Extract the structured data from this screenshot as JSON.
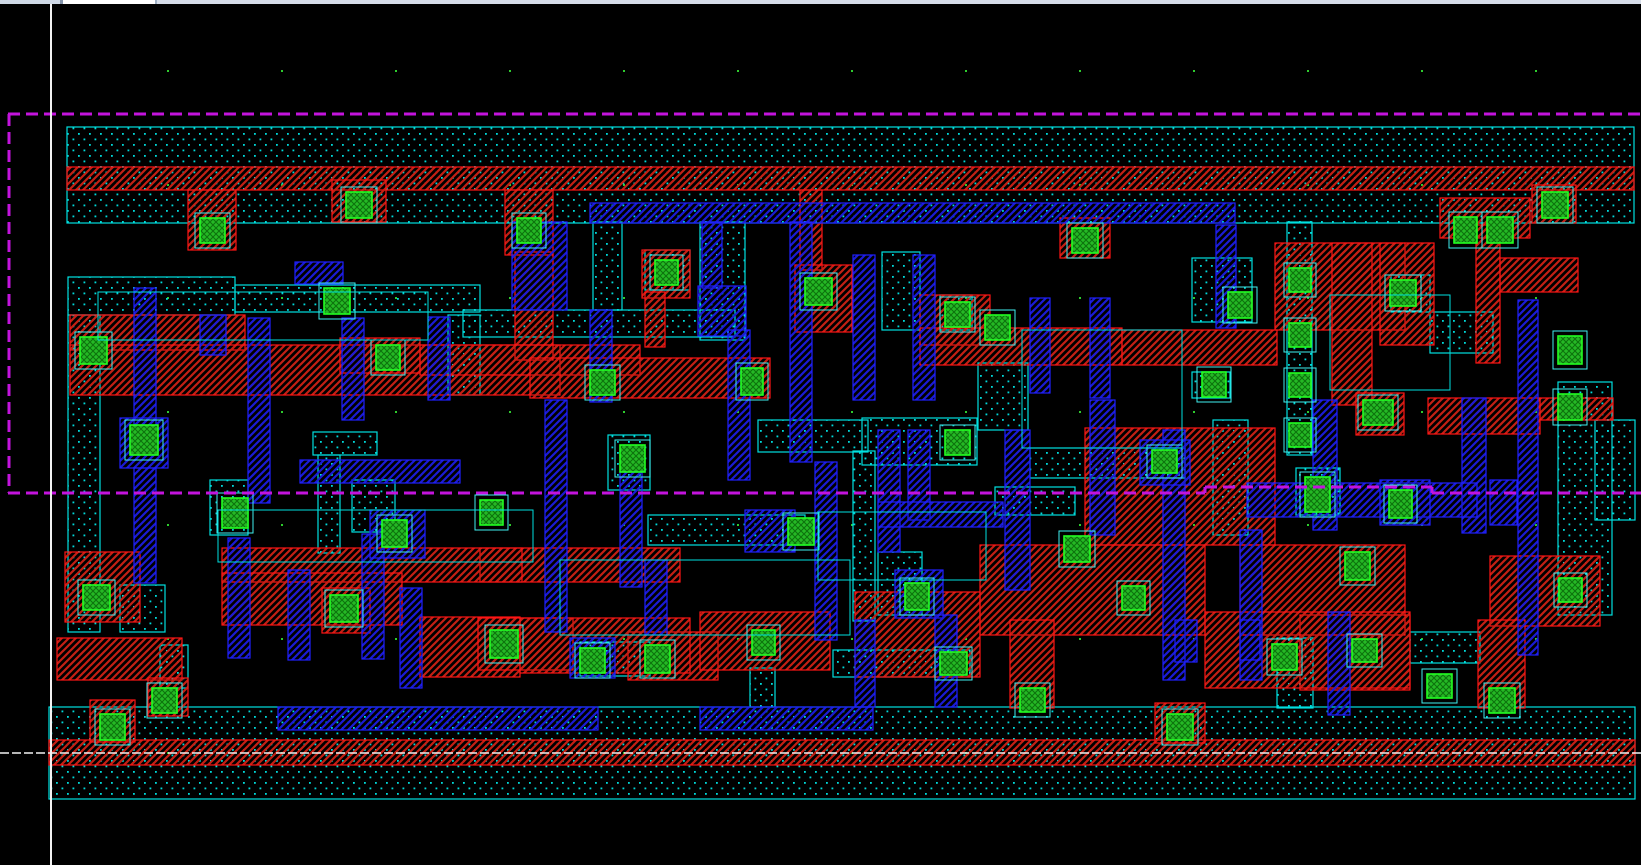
{
  "canvas": {
    "width": 1641,
    "height": 865,
    "background": "#000000"
  },
  "window": {
    "topbar": {
      "height": 4,
      "segments": [
        {
          "x": 0,
          "w": 60,
          "color": "#cfd9e6",
          "name": "topbar-left"
        },
        {
          "x": 60,
          "w": 3,
          "color": "#8494ab",
          "name": "topbar-divider-1"
        },
        {
          "x": 63,
          "w": 92,
          "color": "#ffffff",
          "name": "topbar-white-tab"
        },
        {
          "x": 155,
          "w": 2,
          "color": "#9fb0c4",
          "name": "topbar-divider-2"
        },
        {
          "x": 157,
          "w": 1484,
          "color": "#d6dde9",
          "name": "topbar-right"
        }
      ]
    }
  },
  "colors": {
    "background": "#000000",
    "diff_outline": "#00e0e0",
    "diff_dot": "#00d9d9",
    "red_line": "#c42014",
    "red_outline": "#ff1515",
    "blue_line": "#1b1bd6",
    "blue_outline": "#2020ff",
    "contact_fill": "#25b825",
    "contact_line": "#0d720d",
    "contact_outline": "#22ff22",
    "contact_halo": "#40f0f0",
    "boundary": "#c314dd",
    "axis": "#f2f2f2",
    "grid_dot": "#2ecc2e"
  },
  "grid": {
    "x_start": 167,
    "x_step": 114,
    "x_count": 13,
    "y_rows": [
      70,
      184,
      297,
      411,
      524,
      638,
      752
    ]
  },
  "axes": {
    "vertical_x": 51,
    "vertical_y1": 4,
    "vertical_y2": 865,
    "horizontal_y": 753,
    "horizontal_x1": 0,
    "horizontal_x2": 1641
  },
  "boundary_lines": [
    [
      8,
      114,
      1641,
      114
    ],
    [
      9,
      114,
      9,
      493
    ],
    [
      8,
      493,
      1205,
      493
    ],
    [
      1205,
      487,
      1205,
      493
    ],
    [
      1205,
      487,
      1432,
      487
    ],
    [
      1432,
      487,
      1432,
      493
    ],
    [
      1432,
      493,
      1641,
      493
    ]
  ],
  "layers": {
    "diffusion": [
      [
        67,
        127,
        1567,
        96
      ],
      [
        49,
        707,
        1586,
        92
      ],
      [
        68,
        277,
        167,
        38
      ],
      [
        68,
        315,
        32,
        317
      ],
      [
        235,
        285,
        245,
        27
      ],
      [
        448,
        315,
        32,
        80
      ],
      [
        463,
        310,
        272,
        27
      ],
      [
        593,
        222,
        29,
        88
      ],
      [
        645,
        250,
        45,
        40
      ],
      [
        700,
        222,
        45,
        118
      ],
      [
        648,
        515,
        157,
        30
      ],
      [
        878,
        552,
        44,
        63
      ],
      [
        882,
        252,
        38,
        78
      ],
      [
        940,
        295,
        32,
        35
      ],
      [
        978,
        363,
        50,
        67
      ],
      [
        995,
        487,
        80,
        28
      ],
      [
        1030,
        448,
        155,
        30
      ],
      [
        1192,
        258,
        60,
        64
      ],
      [
        1192,
        372,
        38,
        26
      ],
      [
        1213,
        420,
        35,
        115
      ],
      [
        1287,
        222,
        25,
        233
      ],
      [
        1296,
        468,
        44,
        47
      ],
      [
        1410,
        632,
        70,
        31
      ],
      [
        833,
        650,
        137,
        27
      ],
      [
        580,
        642,
        70,
        34
      ],
      [
        750,
        668,
        25,
        39
      ],
      [
        1277,
        638,
        36,
        70
      ],
      [
        1558,
        382,
        54,
        233
      ],
      [
        1430,
        312,
        63,
        41
      ],
      [
        1391,
        275,
        39,
        37
      ],
      [
        1595,
        420,
        40,
        100
      ],
      [
        160,
        645,
        28,
        43
      ],
      [
        210,
        480,
        38,
        55
      ],
      [
        352,
        480,
        43,
        52
      ],
      [
        608,
        435,
        42,
        55
      ],
      [
        120,
        585,
        45,
        47
      ],
      [
        313,
        432,
        64,
        23
      ],
      [
        318,
        455,
        22,
        98
      ],
      [
        758,
        420,
        110,
        32
      ],
      [
        862,
        418,
        115,
        47
      ],
      [
        853,
        451,
        22,
        170
      ]
    ],
    "red_metal": [
      [
        67,
        167,
        1567,
        23
      ],
      [
        49,
        740,
        1586,
        25
      ],
      [
        188,
        190,
        48,
        60
      ],
      [
        332,
        180,
        54,
        42
      ],
      [
        505,
        190,
        48,
        65
      ],
      [
        515,
        252,
        38,
        108
      ],
      [
        800,
        190,
        22,
        80
      ],
      [
        1060,
        218,
        50,
        40
      ],
      [
        1440,
        198,
        90,
        40
      ],
      [
        1532,
        185,
        44,
        38
      ],
      [
        1275,
        243,
        130,
        87
      ],
      [
        1380,
        243,
        54,
        102
      ],
      [
        1476,
        225,
        24,
        138
      ],
      [
        1500,
        258,
        78,
        34
      ],
      [
        1332,
        243,
        40,
        162
      ],
      [
        70,
        315,
        175,
        35
      ],
      [
        70,
        345,
        490,
        50
      ],
      [
        420,
        345,
        220,
        30
      ],
      [
        530,
        358,
        240,
        40
      ],
      [
        642,
        250,
        48,
        48
      ],
      [
        645,
        292,
        20,
        55
      ],
      [
        795,
        265,
        57,
        67
      ],
      [
        920,
        295,
        70,
        50
      ],
      [
        920,
        328,
        202,
        37
      ],
      [
        1122,
        330,
        155,
        35
      ],
      [
        480,
        548,
        200,
        34
      ],
      [
        222,
        548,
        300,
        34
      ],
      [
        222,
        573,
        180,
        52
      ],
      [
        65,
        552,
        75,
        70
      ],
      [
        57,
        638,
        125,
        42
      ],
      [
        420,
        617,
        100,
        60
      ],
      [
        478,
        618,
        95,
        52
      ],
      [
        628,
        632,
        90,
        48
      ],
      [
        700,
        612,
        130,
        58
      ],
      [
        855,
        592,
        125,
        85
      ],
      [
        980,
        545,
        225,
        90
      ],
      [
        1085,
        428,
        190,
        117
      ],
      [
        1240,
        545,
        165,
        90
      ],
      [
        1300,
        615,
        110,
        75
      ],
      [
        1428,
        398,
        112,
        36
      ],
      [
        1490,
        556,
        110,
        70
      ],
      [
        1478,
        620,
        47,
        88
      ],
      [
        1010,
        620,
        44,
        88
      ],
      [
        1155,
        703,
        50,
        40
      ],
      [
        90,
        700,
        45,
        42
      ],
      [
        148,
        678,
        40,
        38
      ],
      [
        322,
        588,
        48,
        45
      ],
      [
        1356,
        393,
        48,
        42
      ],
      [
        520,
        618,
        170,
        55
      ],
      [
        1205,
        612,
        205,
        76
      ],
      [
        1540,
        398,
        73,
        22
      ],
      [
        340,
        338,
        80,
        35
      ]
    ],
    "blue_metal": [
      [
        590,
        203,
        645,
        20
      ],
      [
        278,
        707,
        320,
        23
      ],
      [
        700,
        707,
        173,
        23
      ],
      [
        855,
        620,
        20,
        87
      ],
      [
        134,
        288,
        22,
        138
      ],
      [
        120,
        418,
        48,
        50
      ],
      [
        134,
        468,
        22,
        115
      ],
      [
        200,
        315,
        26,
        40
      ],
      [
        248,
        318,
        22,
        185
      ],
      [
        228,
        538,
        22,
        120
      ],
      [
        288,
        570,
        22,
        90
      ],
      [
        342,
        318,
        22,
        102
      ],
      [
        362,
        534,
        22,
        125
      ],
      [
        400,
        588,
        22,
        100
      ],
      [
        428,
        317,
        22,
        83
      ],
      [
        512,
        222,
        55,
        88
      ],
      [
        545,
        400,
        22,
        232
      ],
      [
        590,
        310,
        22,
        92
      ],
      [
        620,
        472,
        22,
        115
      ],
      [
        645,
        560,
        22,
        75
      ],
      [
        702,
        222,
        20,
        66
      ],
      [
        698,
        286,
        48,
        50
      ],
      [
        728,
        330,
        22,
        150
      ],
      [
        745,
        510,
        50,
        42
      ],
      [
        790,
        222,
        22,
        240
      ],
      [
        815,
        462,
        22,
        178
      ],
      [
        853,
        255,
        22,
        145
      ],
      [
        878,
        430,
        22,
        122
      ],
      [
        895,
        570,
        48,
        48
      ],
      [
        913,
        255,
        22,
        145
      ],
      [
        908,
        430,
        22,
        90
      ],
      [
        935,
        615,
        22,
        92
      ],
      [
        1030,
        298,
        20,
        95
      ],
      [
        1090,
        298,
        20,
        100
      ],
      [
        1005,
        430,
        25,
        160
      ],
      [
        1090,
        400,
        25,
        135
      ],
      [
        1163,
        430,
        22,
        250
      ],
      [
        1216,
        225,
        20,
        103
      ],
      [
        1240,
        530,
        22,
        150
      ],
      [
        1175,
        620,
        22,
        42
      ],
      [
        1240,
        620,
        20,
        40
      ],
      [
        1313,
        400,
        24,
        130
      ],
      [
        1328,
        612,
        22,
        103
      ],
      [
        1462,
        398,
        24,
        135
      ],
      [
        1490,
        480,
        27,
        45
      ],
      [
        1518,
        300,
        20,
        355
      ],
      [
        295,
        262,
        48,
        22
      ],
      [
        570,
        638,
        45,
        40
      ],
      [
        1140,
        440,
        50,
        45
      ],
      [
        1247,
        483,
        230,
        34
      ],
      [
        1380,
        480,
        50,
        45
      ],
      [
        878,
        502,
        125,
        25
      ],
      [
        300,
        460,
        160,
        23
      ],
      [
        370,
        510,
        55,
        48
      ]
    ],
    "contacts": [
      [
        200,
        218,
        25,
        25
      ],
      [
        346,
        192,
        26,
        26
      ],
      [
        517,
        218,
        24,
        25
      ],
      [
        1072,
        228,
        26,
        25
      ],
      [
        1454,
        217,
        23,
        26
      ],
      [
        1542,
        192,
        26,
        26
      ],
      [
        1487,
        217,
        26,
        26
      ],
      [
        655,
        260,
        23,
        25
      ],
      [
        805,
        278,
        27,
        27
      ],
      [
        945,
        302,
        25,
        25
      ],
      [
        985,
        315,
        25,
        25
      ],
      [
        1228,
        292,
        24,
        26
      ],
      [
        1390,
        280,
        26,
        26
      ],
      [
        1289,
        268,
        22,
        24
      ],
      [
        1289,
        323,
        22,
        24
      ],
      [
        1289,
        373,
        22,
        24
      ],
      [
        1289,
        423,
        22,
        24
      ],
      [
        80,
        337,
        27,
        27
      ],
      [
        324,
        288,
        26,
        26
      ],
      [
        376,
        345,
        24,
        25
      ],
      [
        590,
        370,
        25,
        25
      ],
      [
        741,
        368,
        22,
        27
      ],
      [
        130,
        425,
        28,
        30
      ],
      [
        620,
        445,
        25,
        27
      ],
      [
        945,
        430,
        25,
        25
      ],
      [
        1152,
        450,
        25,
        23
      ],
      [
        1202,
        372,
        24,
        25
      ],
      [
        1363,
        400,
        30,
        25
      ],
      [
        1558,
        336,
        24,
        28
      ],
      [
        1558,
        394,
        24,
        26
      ],
      [
        222,
        498,
        26,
        30
      ],
      [
        382,
        520,
        25,
        27
      ],
      [
        480,
        500,
        23,
        25
      ],
      [
        788,
        518,
        26,
        27
      ],
      [
        905,
        583,
        24,
        27
      ],
      [
        1064,
        536,
        26,
        26
      ],
      [
        1305,
        477,
        25,
        35
      ],
      [
        1389,
        490,
        23,
        28
      ],
      [
        1345,
        552,
        25,
        28
      ],
      [
        1122,
        586,
        23,
        24
      ],
      [
        1559,
        578,
        23,
        24
      ],
      [
        83,
        585,
        27,
        25
      ],
      [
        330,
        595,
        28,
        27
      ],
      [
        490,
        630,
        28,
        28
      ],
      [
        580,
        648,
        25,
        25
      ],
      [
        645,
        645,
        25,
        28
      ],
      [
        752,
        630,
        23,
        25
      ],
      [
        940,
        652,
        27,
        23
      ],
      [
        1020,
        688,
        25,
        24
      ],
      [
        1272,
        644,
        25,
        26
      ],
      [
        1352,
        639,
        25,
        23
      ],
      [
        1427,
        674,
        25,
        24
      ],
      [
        1489,
        688,
        26,
        25
      ],
      [
        100,
        714,
        25,
        26
      ],
      [
        152,
        688,
        25,
        25
      ],
      [
        1167,
        714,
        26,
        26
      ]
    ],
    "wire_loops": [
      [
        98,
        292,
        330,
        48
      ],
      [
        218,
        510,
        315,
        52
      ],
      [
        818,
        512,
        168,
        68
      ],
      [
        1022,
        330,
        160,
        118
      ],
      [
        1330,
        295,
        120,
        95
      ],
      [
        560,
        560,
        290,
        75
      ]
    ]
  }
}
